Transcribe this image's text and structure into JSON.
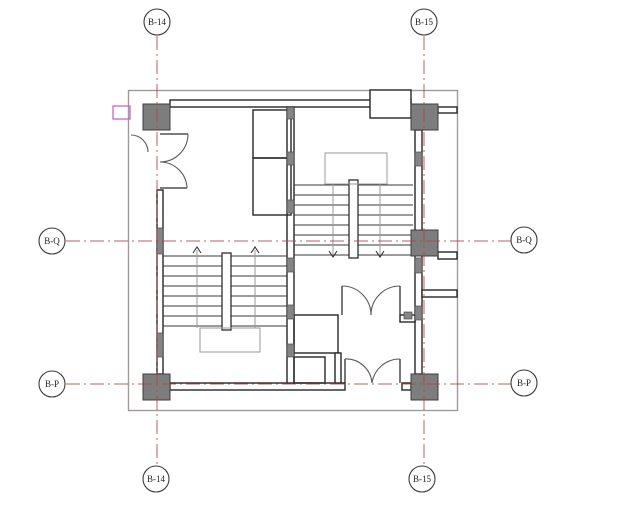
{
  "drawing_type": "stair-core floor plan detail",
  "grid": {
    "top": [
      {
        "label": "B-14"
      },
      {
        "label": "B-15"
      }
    ],
    "bottom": [
      {
        "label": "B-14"
      },
      {
        "label": "B-15"
      }
    ],
    "left": [
      {
        "label": "B-Q"
      },
      {
        "label": "B-P"
      }
    ],
    "right": [
      {
        "label": "B-Q"
      },
      {
        "label": "B-P"
      }
    ]
  },
  "colors": {
    "background": "#ffffff",
    "grid_line": "#b24343",
    "wall": "#262626",
    "wall_fill": "#858585",
    "column_fill": "#7d7d7d",
    "column_stroke": "#3d3d3d",
    "outer_border": "#a09a9a",
    "walk_line": "#9a9a9a",
    "door_arc": "#5a5a5a",
    "highlight": "#c863c8"
  },
  "stairs": {
    "upper": {
      "treads": 8
    },
    "lower": {
      "treads": 8
    }
  }
}
